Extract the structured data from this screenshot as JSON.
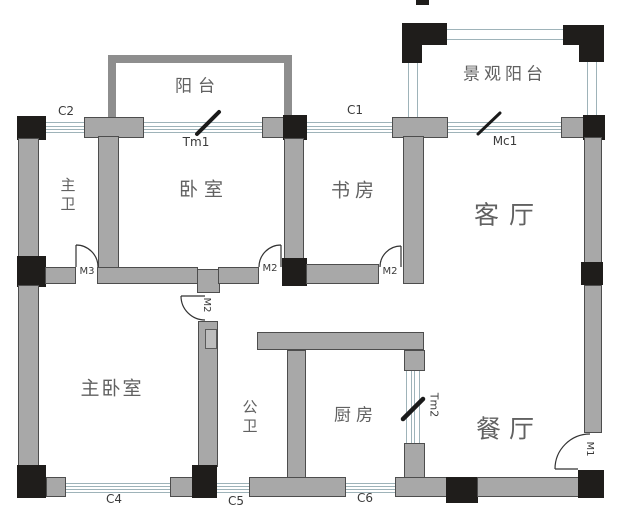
{
  "rooms": {
    "balcony": "阳台",
    "view_balcony": "景观阳台",
    "master_bath": "主卫",
    "bedroom": "卧室",
    "study": "书房",
    "living_room": "客厅",
    "master_bedroom": "主卧室",
    "public_bath": "公卫",
    "kitchen": "厨房",
    "dining_room": "餐厅"
  },
  "openings": {
    "c1": "C1",
    "c2": "C2",
    "c4": "C4",
    "c5": "C5",
    "c6": "C6",
    "tm1": "Tm1",
    "mc1": "Mc1",
    "tm2": "Tm2",
    "m1": "M1",
    "m2_bedroom": "M2",
    "m2_study": "M2",
    "m2_public_bath": "M2",
    "m3": "M3"
  },
  "colors": {
    "background": "#ffffff",
    "wall_fill": "#a8a8a8",
    "wall_border": "#4d4d4d",
    "column": "#1f1d1b",
    "railing": "#8e8e8e",
    "window_line": "#9eb3b9",
    "room_text": "#616161",
    "label_text": "#3a3a3a"
  }
}
